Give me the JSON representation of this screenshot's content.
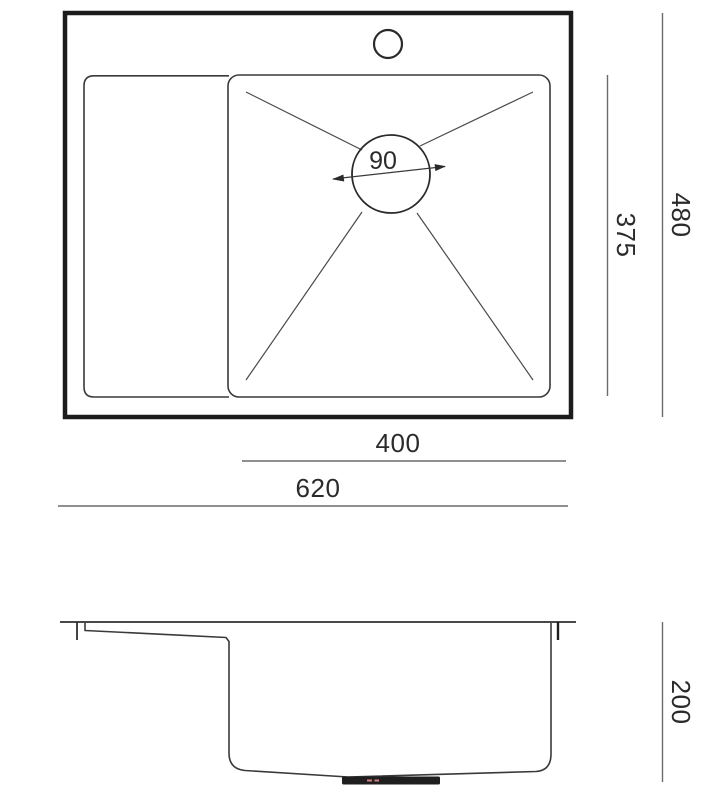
{
  "drawing": {
    "type": "sink-technical-drawing",
    "views": {
      "top_view": "plan view of sink with drainboard, basin, faucet hole and drain",
      "section_view": "side section of bowl with drain fitting"
    },
    "colors": {
      "background": "#ffffff",
      "object_line": "#3a3a3a",
      "thick_outline": "#1c1c1c",
      "dimension_line": "#6b6b6b",
      "text": "#2b2b2b",
      "drain_fitting_fill": "#1f1f1f",
      "center_mark_red": "#d97f7f"
    }
  },
  "top_view": {
    "drain_diameter_label": "90"
  },
  "dimensions": {
    "basin_inner_depth": "375",
    "overall_depth": "480",
    "basin_width": "400",
    "overall_width": "620",
    "bowl_height": "200"
  }
}
